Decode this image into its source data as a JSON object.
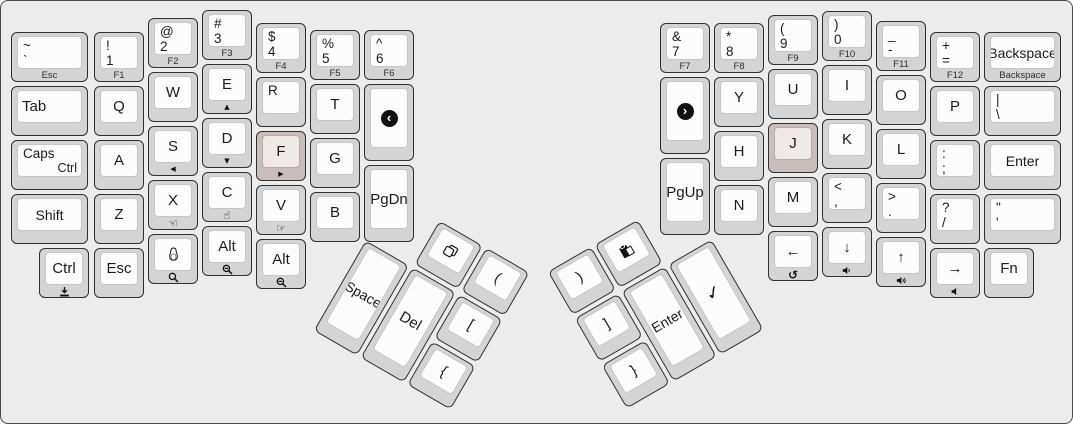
{
  "canvas": {
    "width": 1073,
    "height": 424,
    "bg": "#ececec",
    "border": "#4a4a4a"
  },
  "key_style": {
    "outer_bg": "#d4d4d4",
    "outer_border": "#303030",
    "inner_bg": "#fcfcfc",
    "inner_border": "#c6c6c6",
    "highlight_outer_bg": "#cabdbd",
    "highlight_inner_bg": "#f0e7e7",
    "text_color": "#1b1b1b",
    "front_text_color": "#2d2d2d"
  },
  "clusters": {
    "thumb_left": {
      "x": 391,
      "y": 190,
      "rotation_deg": 30
    },
    "thumb_right": {
      "x": 544,
      "y": 270,
      "rotation_deg": -30
    }
  },
  "keys": [
    {
      "n": "key-grave-esc",
      "cl": "main",
      "x": 10,
      "y": 31,
      "w": 77,
      "tl": "~",
      "tl2": "`",
      "front": "Esc"
    },
    {
      "n": "key-tab",
      "cl": "main",
      "x": 10,
      "y": 85,
      "w": 77,
      "ml": "Tab"
    },
    {
      "n": "key-caps",
      "cl": "main",
      "x": 10,
      "y": 139,
      "w": 77,
      "tl": "Caps",
      "br": "Ctrl"
    },
    {
      "n": "key-shift-left",
      "cl": "main",
      "x": 10,
      "y": 193,
      "w": 77,
      "c": "Shift"
    },
    {
      "n": "key-ctrl-left",
      "cl": "main",
      "x": 38,
      "y": 247,
      "c": "Ctrl",
      "ficon": "download-icon"
    },
    {
      "n": "key-1",
      "cl": "main",
      "x": 93,
      "y": 31,
      "tl": "!",
      "tl2": "1",
      "front": "F1"
    },
    {
      "n": "key-q",
      "cl": "main",
      "x": 93,
      "y": 85,
      "c": "Q"
    },
    {
      "n": "key-a",
      "cl": "main",
      "x": 93,
      "y": 139,
      "c": "A"
    },
    {
      "n": "key-z",
      "cl": "main",
      "x": 93,
      "y": 193,
      "c": "Z"
    },
    {
      "n": "key-esc-left",
      "cl": "main",
      "x": 93,
      "y": 247,
      "c": "Esc"
    },
    {
      "n": "key-2",
      "cl": "main",
      "x": 147,
      "y": 17,
      "tl": "@",
      "tl2": "2",
      "front": "F2"
    },
    {
      "n": "key-w",
      "cl": "main",
      "x": 147,
      "y": 71,
      "c": "W"
    },
    {
      "n": "key-s",
      "cl": "main",
      "x": 147,
      "y": 125,
      "c": "S",
      "ficon": "triangle-left-icon"
    },
    {
      "n": "key-x",
      "cl": "main",
      "x": 147,
      "y": 179,
      "c": "X",
      "ficon": "hand-left-icon"
    },
    {
      "n": "key-penguin",
      "cl": "main",
      "x": 147,
      "y": 233,
      "icon": "penguin-icon",
      "ficon": "magnifier-icon"
    },
    {
      "n": "key-3",
      "cl": "main",
      "x": 201,
      "y": 9,
      "tl": "#",
      "tl2": "3",
      "front": "F3"
    },
    {
      "n": "key-e",
      "cl": "main",
      "x": 201,
      "y": 63,
      "c": "E",
      "ficon": "triangle-up-icon"
    },
    {
      "n": "key-d",
      "cl": "main",
      "x": 201,
      "y": 117,
      "c": "D",
      "ficon": "triangle-down-icon"
    },
    {
      "n": "key-c",
      "cl": "main",
      "x": 201,
      "y": 171,
      "c": "C",
      "ficon": "hand-up-icon"
    },
    {
      "n": "key-alt-left-1",
      "cl": "main",
      "x": 201,
      "y": 225,
      "c": "Alt",
      "ficon": "magnifier-minus-icon"
    },
    {
      "n": "key-4",
      "cl": "main",
      "x": 255,
      "y": 22,
      "tl": "$",
      "tl2": "4",
      "front": "F4"
    },
    {
      "n": "key-r",
      "cl": "main",
      "x": 255,
      "y": 76,
      "tl": "R"
    },
    {
      "n": "key-f",
      "cl": "main",
      "x": 255,
      "y": 130,
      "c": "F",
      "hl": true,
      "ficon": "triangle-right-icon"
    },
    {
      "n": "key-v",
      "cl": "main",
      "x": 255,
      "y": 184,
      "c": "V",
      "ficon": "hand-right-icon"
    },
    {
      "n": "key-alt-left-2",
      "cl": "main",
      "x": 255,
      "y": 238,
      "c": "Alt",
      "ficon": "magnifier-minus-icon"
    },
    {
      "n": "key-5",
      "cl": "main",
      "x": 309,
      "y": 29,
      "tl": "%",
      "tl2": "5",
      "front": "F5"
    },
    {
      "n": "key-t",
      "cl": "main",
      "x": 309,
      "y": 83,
      "c": "T"
    },
    {
      "n": "key-g",
      "cl": "main",
      "x": 309,
      "y": 137,
      "c": "G"
    },
    {
      "n": "key-b",
      "cl": "main",
      "x": 309,
      "y": 191,
      "c": "B"
    },
    {
      "n": "key-6",
      "cl": "main",
      "x": 363,
      "y": 29,
      "tl": "^",
      "tl2": "6",
      "front": "F6"
    },
    {
      "n": "key-browser-back",
      "cl": "main",
      "x": 363,
      "y": 83,
      "h": 77,
      "icon": "circle-back-icon"
    },
    {
      "n": "key-pgdn",
      "cl": "main",
      "x": 363,
      "y": 164,
      "h": 77,
      "c": "PgDn"
    },
    {
      "n": "key-7",
      "cl": "main",
      "x": 659,
      "y": 22,
      "tl": "&",
      "tl2": "7",
      "front": "F7"
    },
    {
      "n": "key-browser-forward",
      "cl": "main",
      "x": 659,
      "y": 76,
      "h": 77,
      "icon": "circle-forward-icon"
    },
    {
      "n": "key-pgup",
      "cl": "main",
      "x": 659,
      "y": 157,
      "h": 77,
      "c": "PgUp"
    },
    {
      "n": "key-8",
      "cl": "main",
      "x": 713,
      "y": 22,
      "tl": "*",
      "tl2": "8",
      "front": "F8"
    },
    {
      "n": "key-y",
      "cl": "main",
      "x": 713,
      "y": 76,
      "c": "Y"
    },
    {
      "n": "key-h",
      "cl": "main",
      "x": 713,
      "y": 130,
      "c": "H"
    },
    {
      "n": "key-n",
      "cl": "main",
      "x": 713,
      "y": 184,
      "c": "N"
    },
    {
      "n": "key-9",
      "cl": "main",
      "x": 767,
      "y": 14,
      "tl": "(",
      "tl2": "9",
      "front": "F9"
    },
    {
      "n": "key-u",
      "cl": "main",
      "x": 767,
      "y": 68,
      "c": "U"
    },
    {
      "n": "key-j",
      "cl": "main",
      "x": 767,
      "y": 122,
      "c": "J",
      "hl": true
    },
    {
      "n": "key-m",
      "cl": "main",
      "x": 767,
      "y": 176,
      "c": "M"
    },
    {
      "n": "key-arrow-left",
      "cl": "main",
      "x": 767,
      "y": 230,
      "c": "←",
      "ficon": "undo-icon"
    },
    {
      "n": "key-0",
      "cl": "main",
      "x": 821,
      "y": 10,
      "tl": ")",
      "tl2": "0",
      "front": "F10"
    },
    {
      "n": "key-i",
      "cl": "main",
      "x": 821,
      "y": 64,
      "c": "I"
    },
    {
      "n": "key-k",
      "cl": "main",
      "x": 821,
      "y": 118,
      "c": "K"
    },
    {
      "n": "key-comma",
      "cl": "main",
      "x": 821,
      "y": 172,
      "tl": "<",
      "tl2": ","
    },
    {
      "n": "key-arrow-down",
      "cl": "main",
      "x": 821,
      "y": 226,
      "c": "↓",
      "ficon": "volume-down-icon"
    },
    {
      "n": "key-dash",
      "cl": "main",
      "x": 875,
      "y": 20,
      "tl": "_",
      "tl2": "-",
      "front": "F11"
    },
    {
      "n": "key-o",
      "cl": "main",
      "x": 875,
      "y": 74,
      "c": "O"
    },
    {
      "n": "key-l",
      "cl": "main",
      "x": 875,
      "y": 128,
      "c": "L"
    },
    {
      "n": "key-period",
      "cl": "main",
      "x": 875,
      "y": 182,
      "tl": ">",
      "tl2": "."
    },
    {
      "n": "key-arrow-up",
      "cl": "main",
      "x": 875,
      "y": 236,
      "c": "↑",
      "ficon": "volume-up-icon"
    },
    {
      "n": "key-equals",
      "cl": "main",
      "x": 929,
      "y": 31,
      "tl": "+",
      "tl2": "=",
      "front": "F12"
    },
    {
      "n": "key-p",
      "cl": "main",
      "x": 929,
      "y": 85,
      "c": "P"
    },
    {
      "n": "key-semicolon",
      "cl": "main",
      "x": 929,
      "y": 139,
      "tl": ":",
      "tl2": ";"
    },
    {
      "n": "key-slash",
      "cl": "main",
      "x": 929,
      "y": 193,
      "tl": "?",
      "tl2": "/"
    },
    {
      "n": "key-arrow-right",
      "cl": "main",
      "x": 929,
      "y": 247,
      "c": "→",
      "ficon": "volume-mute-icon"
    },
    {
      "n": "key-backspace",
      "cl": "main",
      "x": 983,
      "y": 31,
      "w": 77,
      "c": "Backspace",
      "front": "Backspace"
    },
    {
      "n": "key-backslash",
      "cl": "main",
      "x": 983,
      "y": 85,
      "w": 77,
      "tl": "|",
      "tl2": "\\"
    },
    {
      "n": "key-enter-right",
      "cl": "main",
      "x": 983,
      "y": 139,
      "w": 77,
      "c": "Enter"
    },
    {
      "n": "key-quote",
      "cl": "main",
      "x": 983,
      "y": 193,
      "w": 77,
      "tl": "\"",
      "tl2": "'"
    },
    {
      "n": "key-fn",
      "cl": "main",
      "x": 983,
      "y": 247,
      "c": "Fn"
    },
    {
      "n": "key-copy",
      "cl": "tl",
      "x": 56,
      "y": 2,
      "icon": "copy-icon"
    },
    {
      "n": "key-paren-left",
      "cl": "tl",
      "x": 110,
      "y": 2,
      "c": "("
    },
    {
      "n": "key-space",
      "cl": "tl",
      "x": 2,
      "y": 56,
      "h": 104,
      "c": "Space"
    },
    {
      "n": "key-del",
      "cl": "tl",
      "x": 56,
      "y": 56,
      "h": 104,
      "c": "Del"
    },
    {
      "n": "key-bracket-left",
      "cl": "tl",
      "x": 110,
      "y": 56,
      "c": "["
    },
    {
      "n": "key-brace-left",
      "cl": "tl",
      "x": 110,
      "y": 110,
      "c": "{"
    },
    {
      "n": "key-paren-right",
      "cl": "tr",
      "x": 2,
      "y": 2,
      "c": ")"
    },
    {
      "n": "key-paste",
      "cl": "tr",
      "x": 56,
      "y": 2,
      "icon": "paste-icon"
    },
    {
      "n": "key-bracket-right",
      "cl": "tr",
      "x": 2,
      "y": 56,
      "c": "]"
    },
    {
      "n": "key-enter-thumb",
      "cl": "tr",
      "x": 56,
      "y": 56,
      "h": 104,
      "c": "Enter"
    },
    {
      "n": "key-check",
      "cl": "tr",
      "x": 110,
      "y": 56,
      "h": 104,
      "icon": "check-icon"
    },
    {
      "n": "key-brace-right",
      "cl": "tr",
      "x": 2,
      "y": 110,
      "c": "}"
    }
  ]
}
